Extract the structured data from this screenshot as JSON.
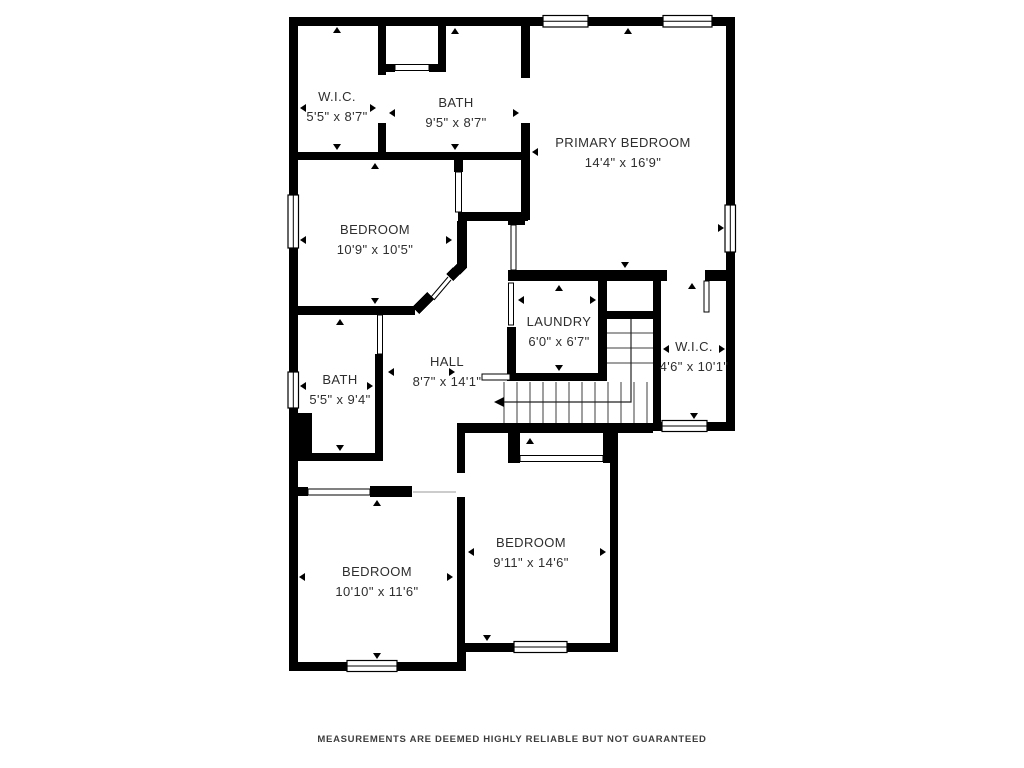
{
  "plan": {
    "background": "#ffffff",
    "wall_color": "#000000",
    "footer": "MEASUREMENTS ARE DEEMED HIGHLY RELIABLE BUT NOT GUARANTEED",
    "rooms": [
      {
        "name": "W.I.C.",
        "dims": "5'5\" x 8'7\""
      },
      {
        "name": "BATH",
        "dims": "9'5\" x 8'7\""
      },
      {
        "name": "PRIMARY BEDROOM",
        "dims": "14'4\" x 16'9\""
      },
      {
        "name": "BEDROOM",
        "dims": "10'9\" x 10'5\""
      },
      {
        "name": "LAUNDRY",
        "dims": "6'0\" x 6'7\""
      },
      {
        "name": "W.I.C.",
        "dims": "4'6\" x 10'1\""
      },
      {
        "name": "BATH",
        "dims": "5'5\" x 9'4\""
      },
      {
        "name": "HALL",
        "dims": "8'7\" x 14'1\""
      },
      {
        "name": "BEDROOM",
        "dims": "9'11\" x 14'6\""
      },
      {
        "name": "BEDROOM",
        "dims": "10'10\" x 11'6\""
      }
    ]
  }
}
